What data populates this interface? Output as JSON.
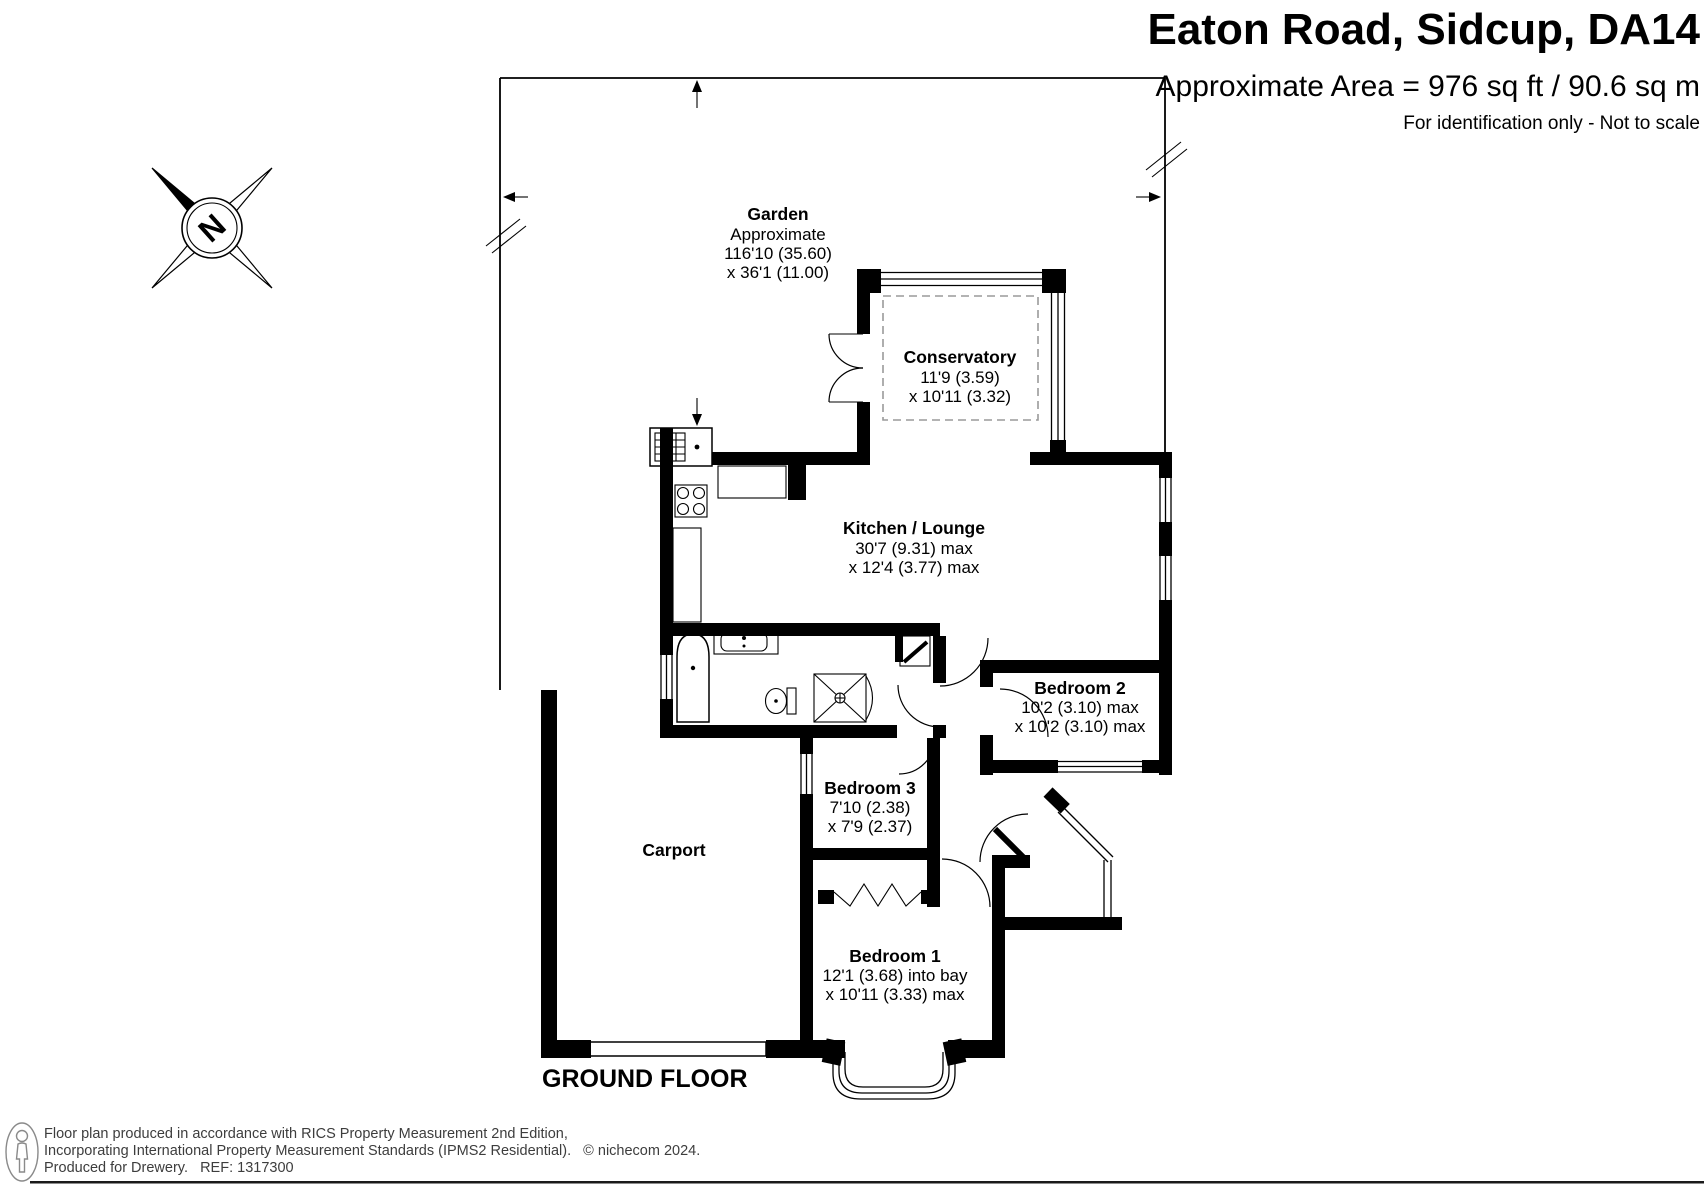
{
  "header": {
    "title": "Eaton Road, Sidcup, DA14",
    "area": "Approximate Area = 976 sq ft / 90.6 sq m",
    "disclaimer": "For identification only - Not to scale"
  },
  "compass": {
    "north": "N"
  },
  "garden": {
    "name": "Garden",
    "approx": "Approximate",
    "dim1": "116'10 (35.60)",
    "dim2": "x 36'1 (11.00)"
  },
  "rooms": {
    "conservatory": {
      "name": "Conservatory",
      "dim1": "11'9 (3.59)",
      "dim2": "x 10'11 (3.32)"
    },
    "kitchen": {
      "name": "Kitchen / Lounge",
      "dim1": "30'7 (9.31) max",
      "dim2": "x 12'4 (3.77) max"
    },
    "bedroom2": {
      "name": "Bedroom 2",
      "dim1": "10'2 (3.10) max",
      "dim2": "x 10'2 (3.10) max"
    },
    "bedroom3": {
      "name": "Bedroom 3",
      "dim1": "7'10 (2.38)",
      "dim2": "x 7'9 (2.37)"
    },
    "bedroom1": {
      "name": "Bedroom 1",
      "dim1": "12'1 (3.68) into bay",
      "dim2": "x 10'11 (3.33) max"
    },
    "carport": {
      "name": "Carport"
    }
  },
  "floor_label": "GROUND FLOOR",
  "footer": {
    "line1": "Floor plan produced in accordance with RICS Property Measurement 2nd Edition,",
    "line2": "Incorporating International Property Measurement Standards (IPMS2 Residential).   © nichecom 2024.",
    "line3": "Produced for Drewery.   REF: 1317300"
  }
}
